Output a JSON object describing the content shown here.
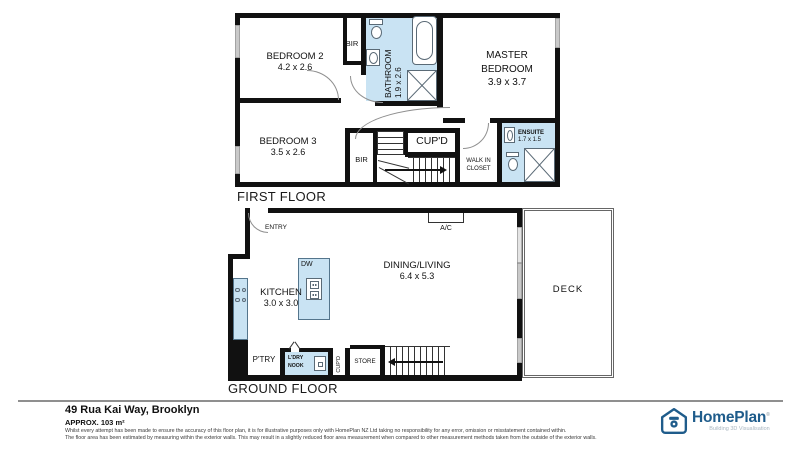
{
  "first_floor": {
    "title": "FIRST FLOOR",
    "bedroom2": {
      "name": "BEDROOM 2",
      "dims": "4.2 x 2.6"
    },
    "bedroom3": {
      "name": "BEDROOM 3",
      "dims": "3.5 x 2.6"
    },
    "master_bedroom": {
      "line1": "MASTER",
      "line2": "BEDROOM",
      "dims": "3.9 x 3.7"
    },
    "bathroom": {
      "name": "BATHROOM",
      "dims": "1.9 x 2.6"
    },
    "ensuite": {
      "name": "ENSUITE",
      "dims": "1.7 x 1.5"
    },
    "bir_upper": "BIR",
    "bir_lower": "BIR",
    "cupboard": "CUP'D",
    "walk_in_closet": {
      "line1": "WALK IN",
      "line2": "CLOSET"
    }
  },
  "ground_floor": {
    "title": "GROUND FLOOR",
    "entry": "ENTRY",
    "air_con": "A/C",
    "dining_living": {
      "name": "DINING/LIVING",
      "dims": "6.4 x 5.3"
    },
    "kitchen": {
      "name": "KITCHEN",
      "dims": "3.0 x 3.0"
    },
    "dishwasher": "DW",
    "deck": "DECK",
    "pantry": "P'TRY",
    "laundry_nook": {
      "line1": "L'DRY",
      "line2": "NOOK"
    },
    "cupboard": "CUP'D",
    "store": "STORE"
  },
  "footer": {
    "address": "49 Rua Kai Way, Brooklyn",
    "area": "APPROX. 103 m²",
    "disclaimer_line1": "Whilst every attempt has been made to ensure the accuracy of this floor plan, it is for illustrative purposes only with HomePlan NZ Ltd taking no responsibility for any error, omission or misstatement contained within.",
    "disclaimer_line2": "The floor area has been estimated by measuring within the exterior walls. This may result in a slightly reduced floor area measurement when compared to other measurement methods taken from the outside of the exterior walls.",
    "brand": {
      "name": "HomePlan",
      "mark": "®",
      "tagline": "Building 3D Visualisation"
    }
  },
  "colors": {
    "wall": "#111111",
    "wet_area_blue": "#c9e3f3",
    "window": "#c9c9c9",
    "brand_blue": "#1f5c8b",
    "tagline_gray": "#a9b6c0"
  }
}
